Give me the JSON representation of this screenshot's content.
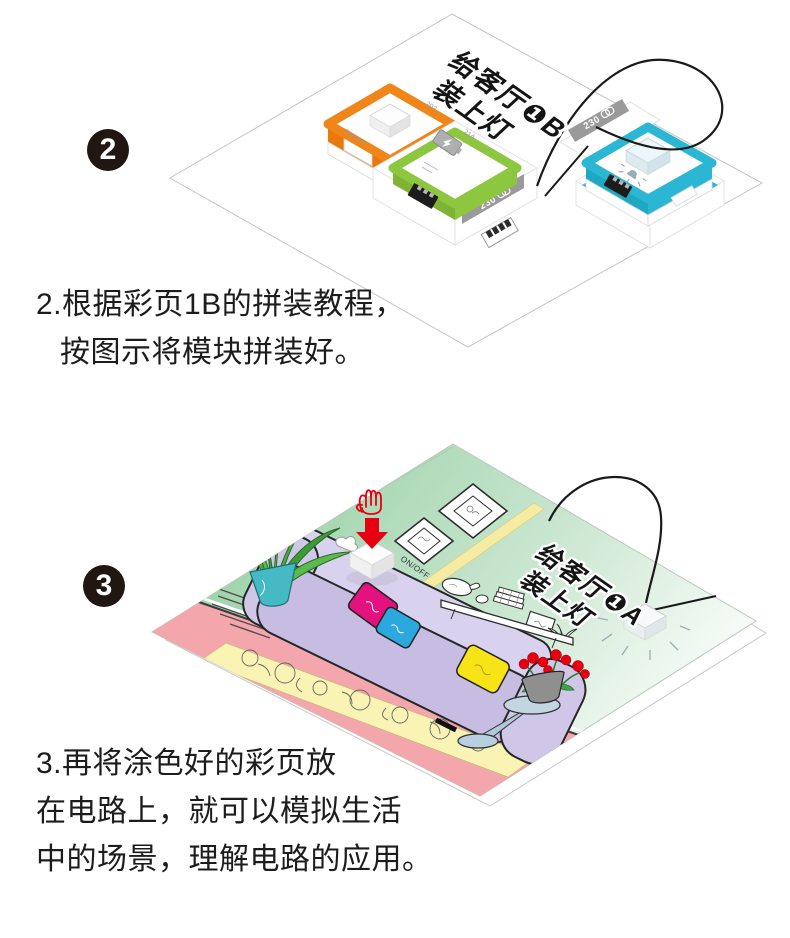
{
  "step2": {
    "badge": "2",
    "caption": {
      "line1": "2.根据彩页1B的拼装教程，",
      "line2": "按图示将模块拼装好。"
    },
    "illustration": {
      "board_label": {
        "line1": "给客厅❶B",
        "line2": "装上灯"
      },
      "switch_module": {
        "number": "202",
        "label": "ON/OFF",
        "color": "#F08519"
      },
      "battery_module": {
        "number": "214",
        "color": "#8DC63F"
      },
      "wire_band_left": "230",
      "wire_band_right": "230",
      "lamp_module": {
        "color": "#2BB7D3"
      }
    }
  },
  "step3": {
    "badge": "3",
    "caption": {
      "line1": "3.再将涂色好的彩页放",
      "line2": "在电路上，就可以模拟生活",
      "line3": "中的场景，理解电路的应用。"
    },
    "illustration": {
      "board_label": {
        "line1": "给客厅❶A",
        "line2": "装上灯"
      },
      "button_label": "ON/OFF",
      "colors": {
        "wall": "#9CD2A9",
        "floor": "#F3A6AB",
        "rug": "#F9F3B4",
        "sofa": "#C7BCE2",
        "pillow_pink": "#E4127F",
        "pillow_blue": "#2BA9DE",
        "pillow_yellow": "#F8E316",
        "pot_teal": "#45B9C4",
        "flower_red": "#E60012"
      }
    }
  }
}
